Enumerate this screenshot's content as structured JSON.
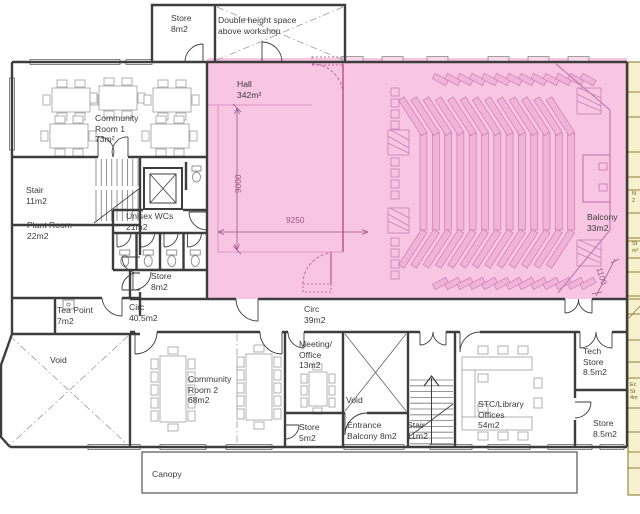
{
  "plan": {
    "labels": {
      "store_top": "Store\n8m2",
      "double_height": "Double height space\nabove workshop",
      "hall": "Hall\n342m²",
      "community_room_1": "Community\nRoom 1\n73m²",
      "stair_1": "Stair\n11m2",
      "plant_room": "Plant Room\n22m2",
      "unisex_wcs": "Unisex WCs\n21m2",
      "store_wcs": "Store\n8m2",
      "tea_point": "Tea Point\n7m2",
      "circ_405": "Circ\n40.5m2",
      "circ_39": "Circ\n39m2",
      "balcony": "Balcony\n33m2",
      "void_left": "Void",
      "community_room_2": "Community\nRoom 2\n68m2",
      "meeting_office": "Meeting/\nOffice\n13m2",
      "void_center": "Void",
      "store_5": "Store\n5m2",
      "entrance_balcony": "Entrance\nBalcony 8m2",
      "stair_2": "Stair\n11m2",
      "stc_library": "STC/Library\nOffices\n54m2",
      "tech_store": "Tech\nStore\n8.5m2",
      "store_85": "Store\n8.5m2",
      "canopy": "Canopy"
    },
    "dimensions": {
      "stage_width": "9250",
      "stage_depth": "9000",
      "balcony_depth": "1100"
    },
    "adjacent_fragments": {
      "frag_1": "N\n2",
      "frag_2": "St\nm²",
      "frag_3": "Ec\nSt\n4m"
    },
    "colors": {
      "hall_highlight": "#f8c6e2",
      "hall_lines": "#c97fb4",
      "hall_dark_lines": "#b06a9a",
      "adjacent_fill": "#f8f1cf",
      "adjacent_lines": "#8f7d3e",
      "wall": "#3d3d3d",
      "furniture": "#a8a8a8",
      "text": "#3a3a3a",
      "dimension_text": "#9c5586"
    }
  }
}
